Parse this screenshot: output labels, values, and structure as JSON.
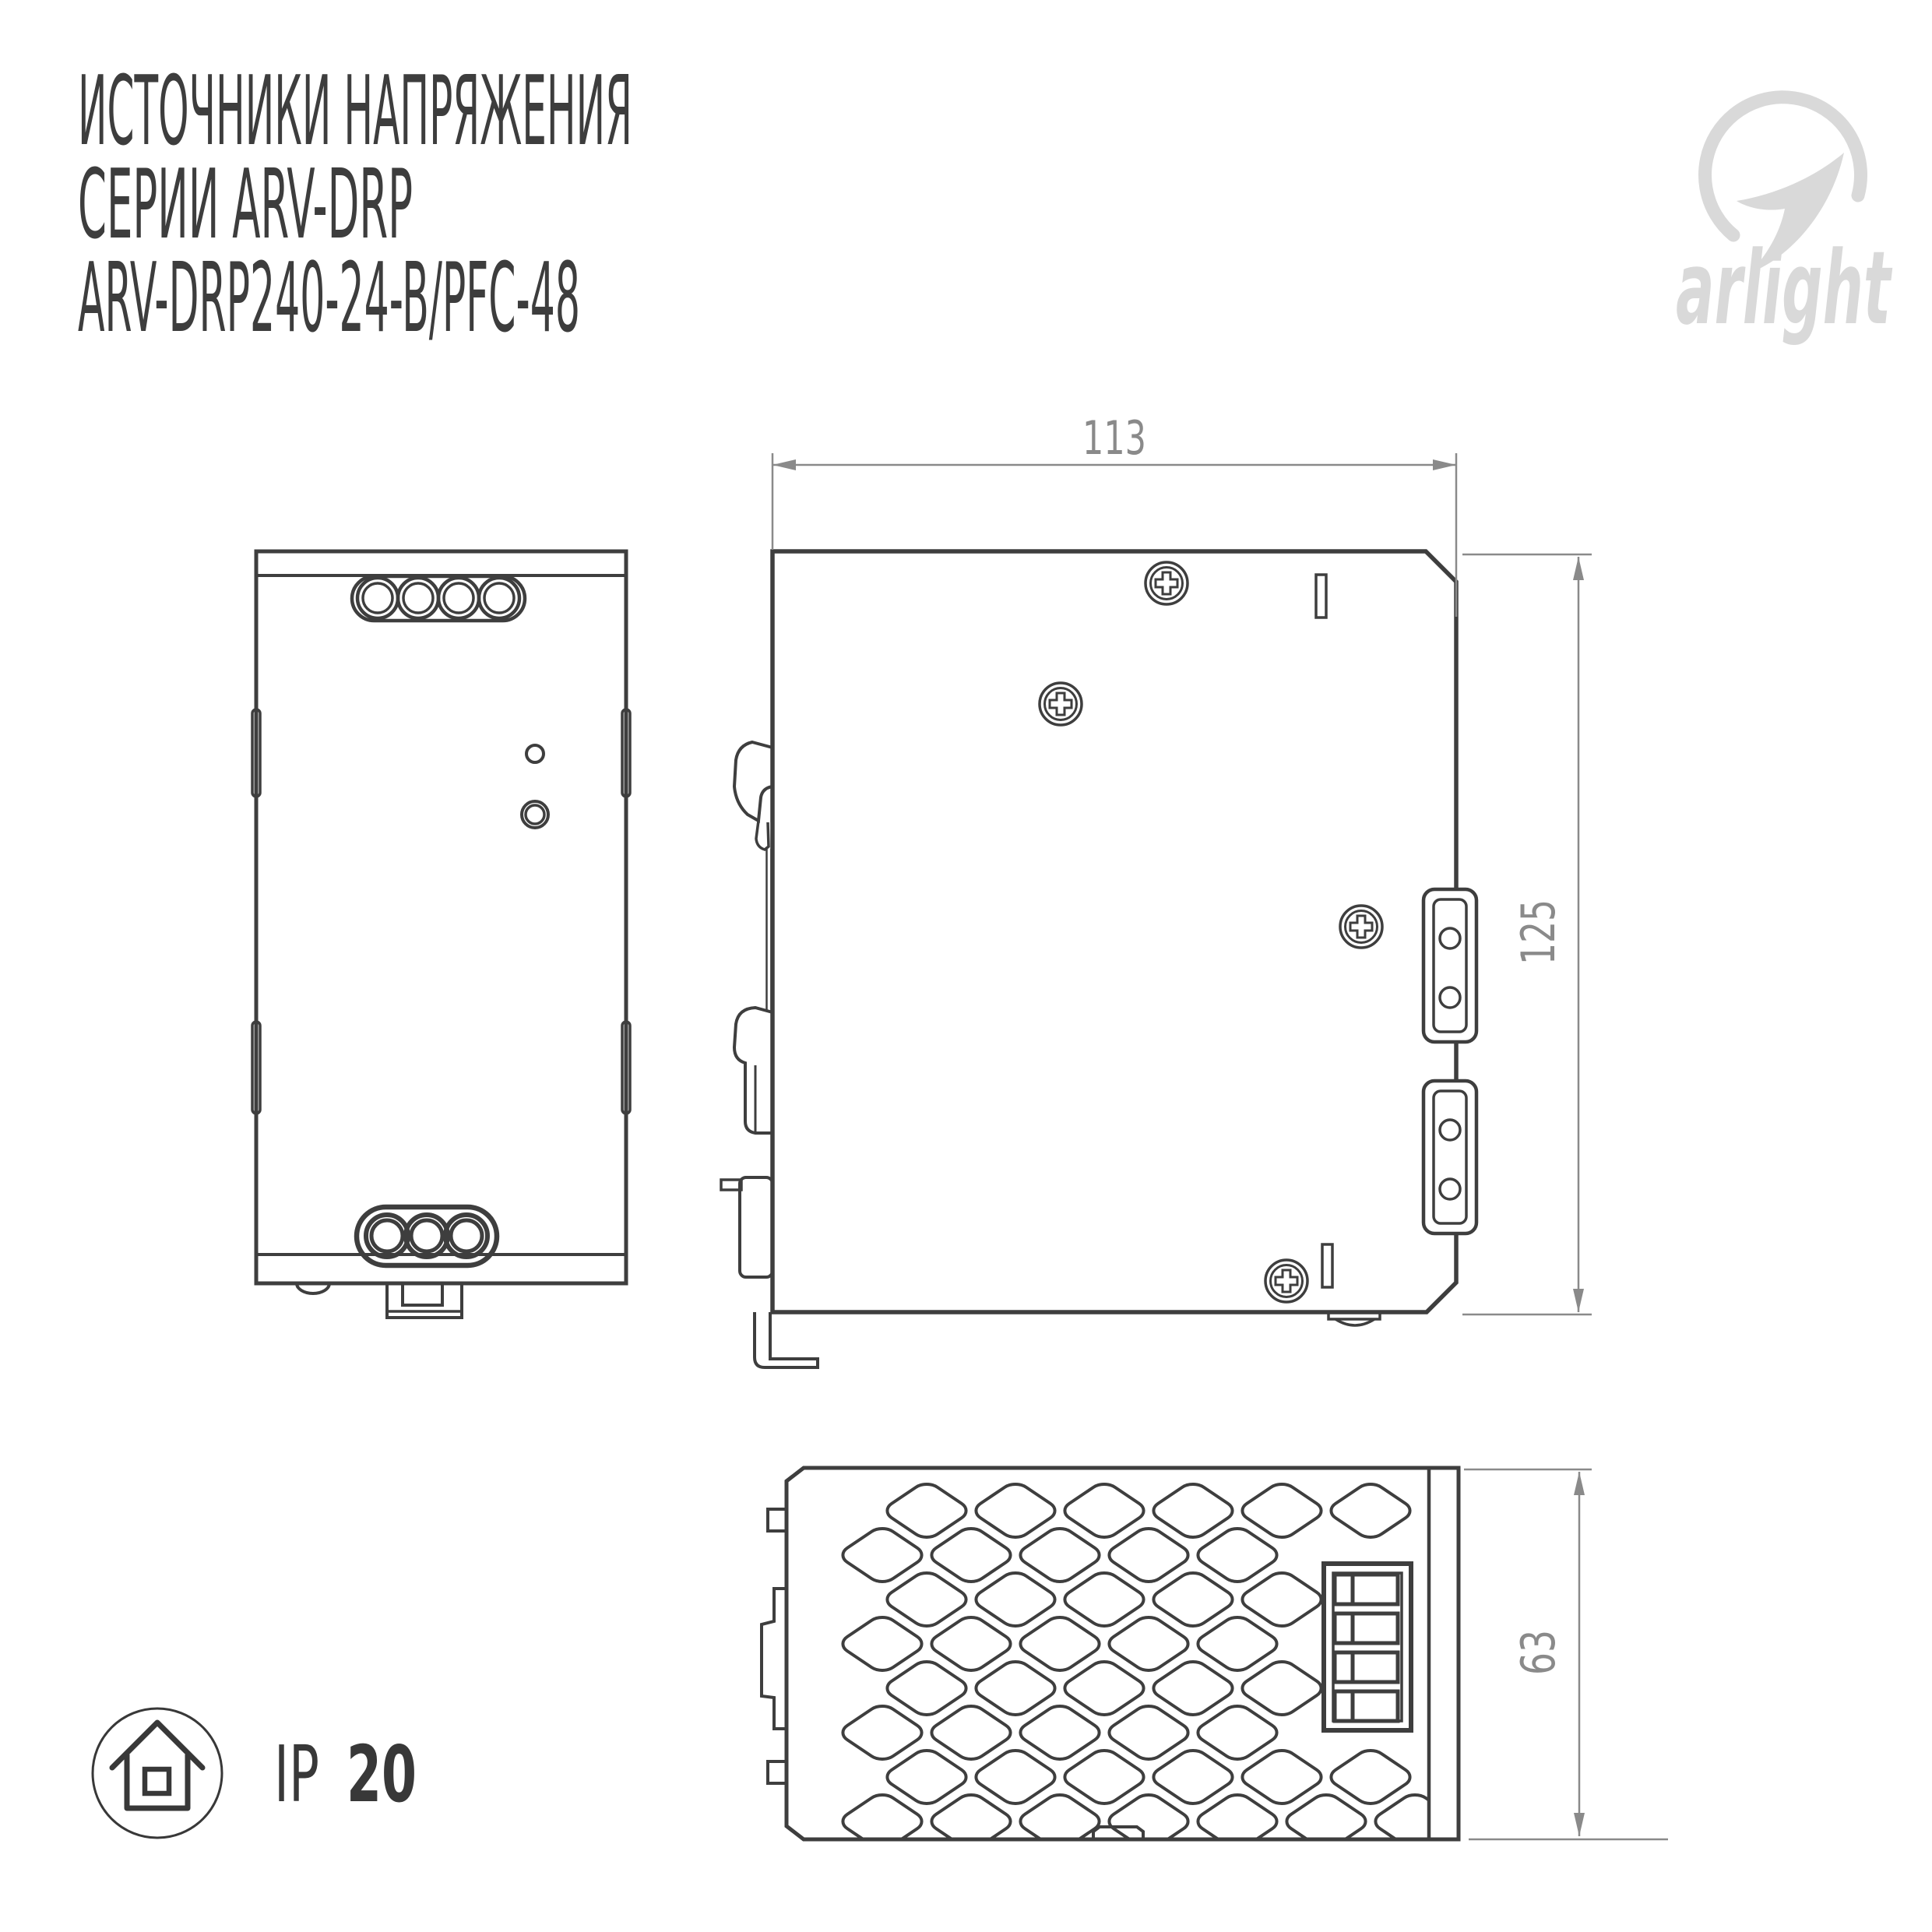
{
  "title": {
    "line1": "ИСТОЧНИКИ НАПРЯЖЕНИЯ",
    "line2": "СЕРИИ ARV-DRP",
    "line3": "ARV-DRP240-24-B/PFC-48"
  },
  "brand": {
    "name": "arlight",
    "mark_icon": "arlight-swoosh-icon"
  },
  "drawing": {
    "dim_width_mm": "113",
    "dim_height_mm": "125",
    "dim_depth_mm": "63"
  },
  "badge": {
    "icon": "house-icon",
    "prefix": "IP",
    "value": "20"
  },
  "colors": {
    "drawing_line": "#3e3e3e",
    "dimension": "#8a8a8a",
    "title_text": "#3d3d3d",
    "logo": "#d9d9d9",
    "badge_text": "#383838"
  }
}
